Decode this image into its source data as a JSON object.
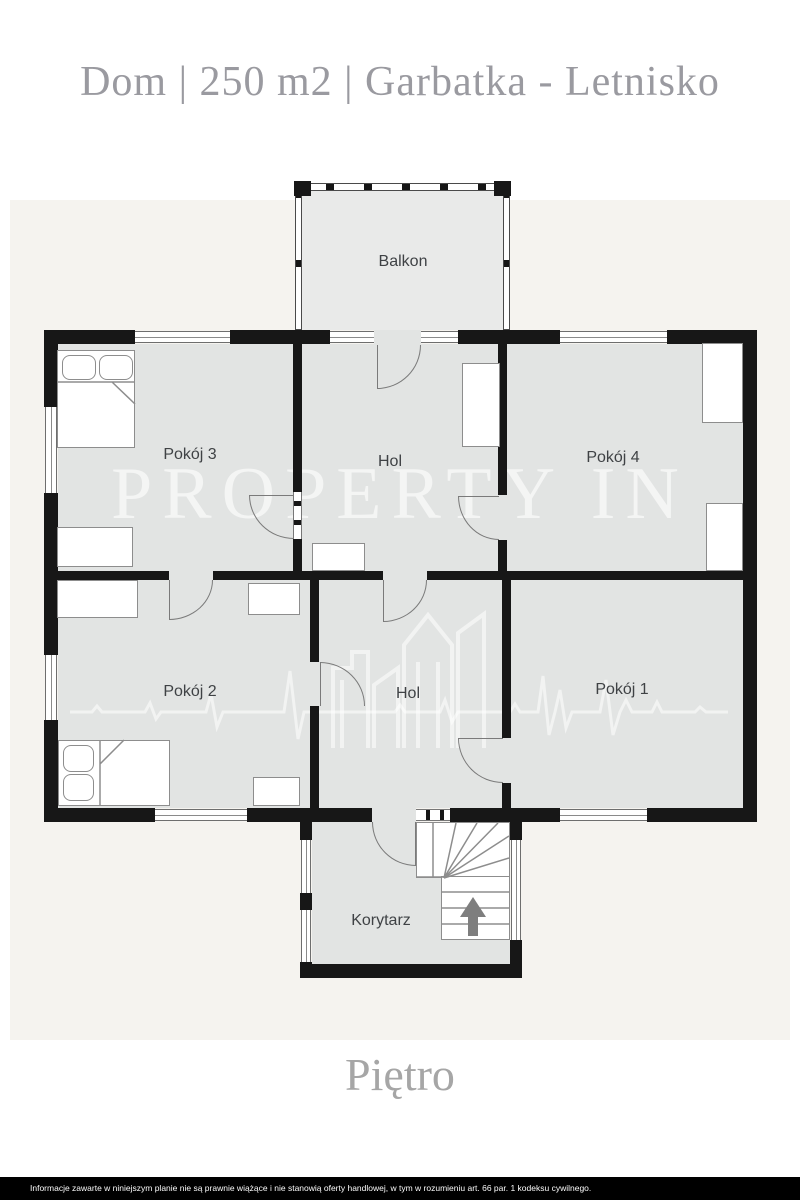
{
  "header": {
    "title": "Dom | 250 m2 | Garbatka - Letnisko"
  },
  "floorplan": {
    "rooms": [
      {
        "id": "balkon",
        "label": "Balkon"
      },
      {
        "id": "pokoj-3",
        "label": "Pokój 3"
      },
      {
        "id": "hol-gorny",
        "label": "Hol"
      },
      {
        "id": "pokoj-4",
        "label": "Pokój 4"
      },
      {
        "id": "pokoj-2",
        "label": "Pokój 2"
      },
      {
        "id": "hol-dolny",
        "label": "Hol"
      },
      {
        "id": "pokoj-1",
        "label": "Pokój 1"
      },
      {
        "id": "korytarz",
        "label": "Korytarz"
      }
    ],
    "stairs": {
      "direction_icon": "arrow-up"
    }
  },
  "watermark": {
    "brand": "PROPERTY IN",
    "logo": "skyline-and-ecg-line"
  },
  "floor": {
    "label": "Piętro"
  },
  "footer": {
    "disclaimer": "Informacje zawarte w niniejszym planie nie są prawnie wiążące i nie stanowią oferty handlowej, w tym w rozumieniu art. 66 par. 1 kodeksu cywilnego."
  },
  "colors": {
    "wall": "#171717",
    "room_fill": "#e2e4e3",
    "balcony_fill": "#e9eae9",
    "backdrop_panel": "#f5f3ef",
    "title_text": "#9a9aa0",
    "room_label_text": "#3f4245",
    "footer_bg": "#000000",
    "footer_text": "#fbfbfb"
  }
}
